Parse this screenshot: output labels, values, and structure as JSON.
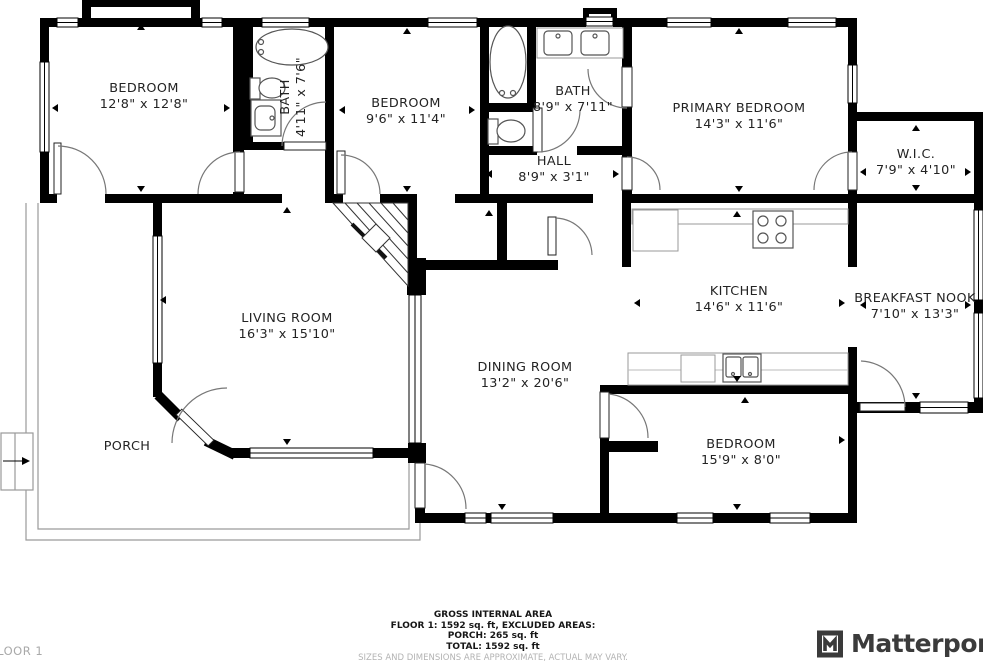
{
  "plan": {
    "rooms": [
      {
        "name": "BEDROOM",
        "dims": "12'8\" x 12'8\""
      },
      {
        "name": "BATH",
        "dims": "4'11\" x 7'6\""
      },
      {
        "name": "BEDROOM",
        "dims": "9'6\" x 11'4\""
      },
      {
        "name": "BATH",
        "dims": "8'9\" x 7'11\""
      },
      {
        "name": "HALL",
        "dims": "8'9\" x 3'1\""
      },
      {
        "name": "PRIMARY BEDROOM",
        "dims": "14'3\" x 11'6\""
      },
      {
        "name": "W.I.C.",
        "dims": "7'9\" x 4'10\""
      },
      {
        "name": "KITCHEN",
        "dims": "14'6\" x 11'6\""
      },
      {
        "name": "BREAKFAST NOOK",
        "dims": "7'10\" x 13'3\""
      },
      {
        "name": "LIVING ROOM",
        "dims": "16'3\" x 15'10\""
      },
      {
        "name": "DINING ROOM",
        "dims": "13'2\" x 20'6\""
      },
      {
        "name": "PORCH",
        "dims": ""
      },
      {
        "name": "BEDROOM",
        "dims": "15'9\" x 8'0\""
      }
    ],
    "floor_label": "FLOOR 1"
  },
  "footer": {
    "line1": "GROSS INTERNAL AREA",
    "line2": "FLOOR 1: 1592 sq. ft, EXCLUDED AREAS:",
    "line3": "PORCH: 265 sq. ft",
    "line4": "TOTAL: 1592 sq. ft",
    "disclaimer": "SIZES AND DIMENSIONS ARE APPROXIMATE, ACTUAL MAY VARY."
  },
  "branding": {
    "logo_text": "Matterport"
  }
}
